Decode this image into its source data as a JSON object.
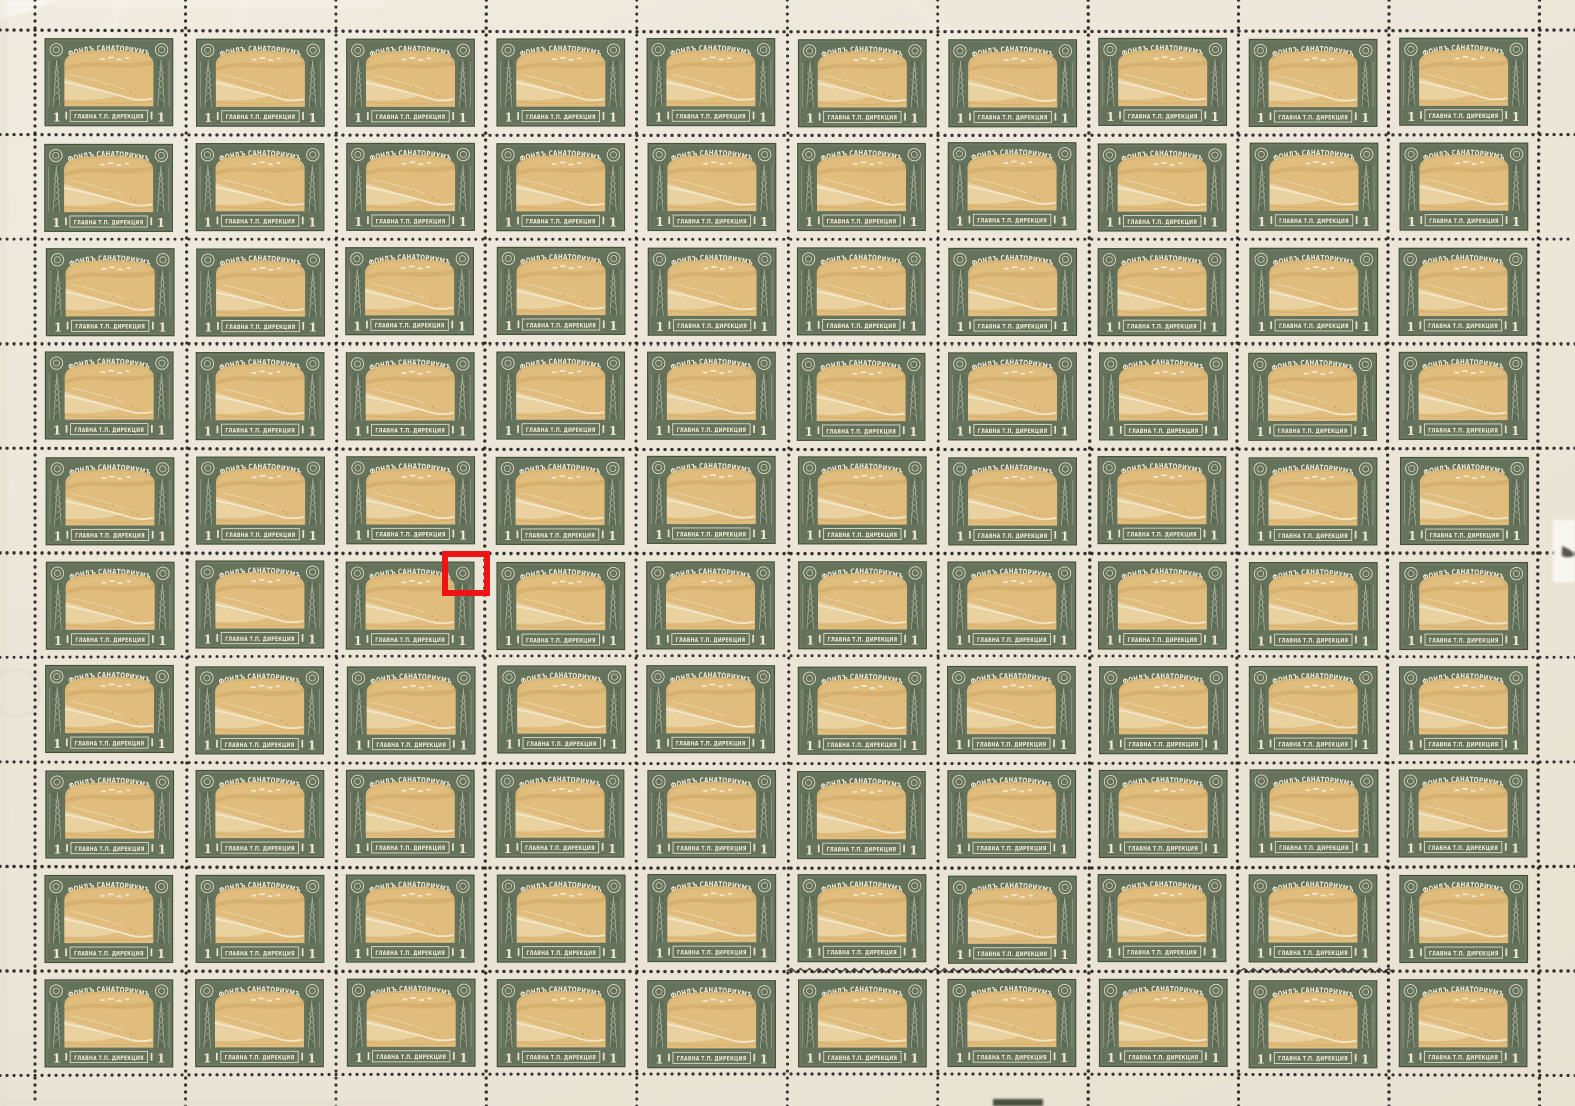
{
  "sheet": {
    "description": "Full scanned sheet of identical charity revenue stamps, perforated grid",
    "rows": 10,
    "cols": 10,
    "stamp": {
      "top_text": "ФОНДЪ САНАТОРИУМЪ",
      "bottom_text": "ГЛАВНА Т.П. ДИРЕКЦИЯ",
      "denomination_left": "1",
      "denomination_right": "1",
      "vignette": "ochre landscape view with winding road and buildings",
      "ornaments": "posthorn roundel in each upper corner, lattice mast pillars at sides"
    },
    "annotation": {
      "type": "highlight-box",
      "color": "#ee1414",
      "row": 6,
      "col": 3,
      "highlights": "top-right posthorn ornament of the stamp"
    },
    "colors": {
      "paper": "#ebe5d8",
      "frame_green": "#66735c",
      "frame_green_dark": "#44503a",
      "frame_green_light": "#aab39d",
      "stamp_text_cream": "#efe9d2",
      "vignette_tan": "#e0bc7d",
      "vignette_tan_dark": "#d2a967",
      "vignette_tan_light": "#f2e6c4",
      "perforation_dot": "#24231e",
      "annotation_red": "#ee1414"
    }
  }
}
